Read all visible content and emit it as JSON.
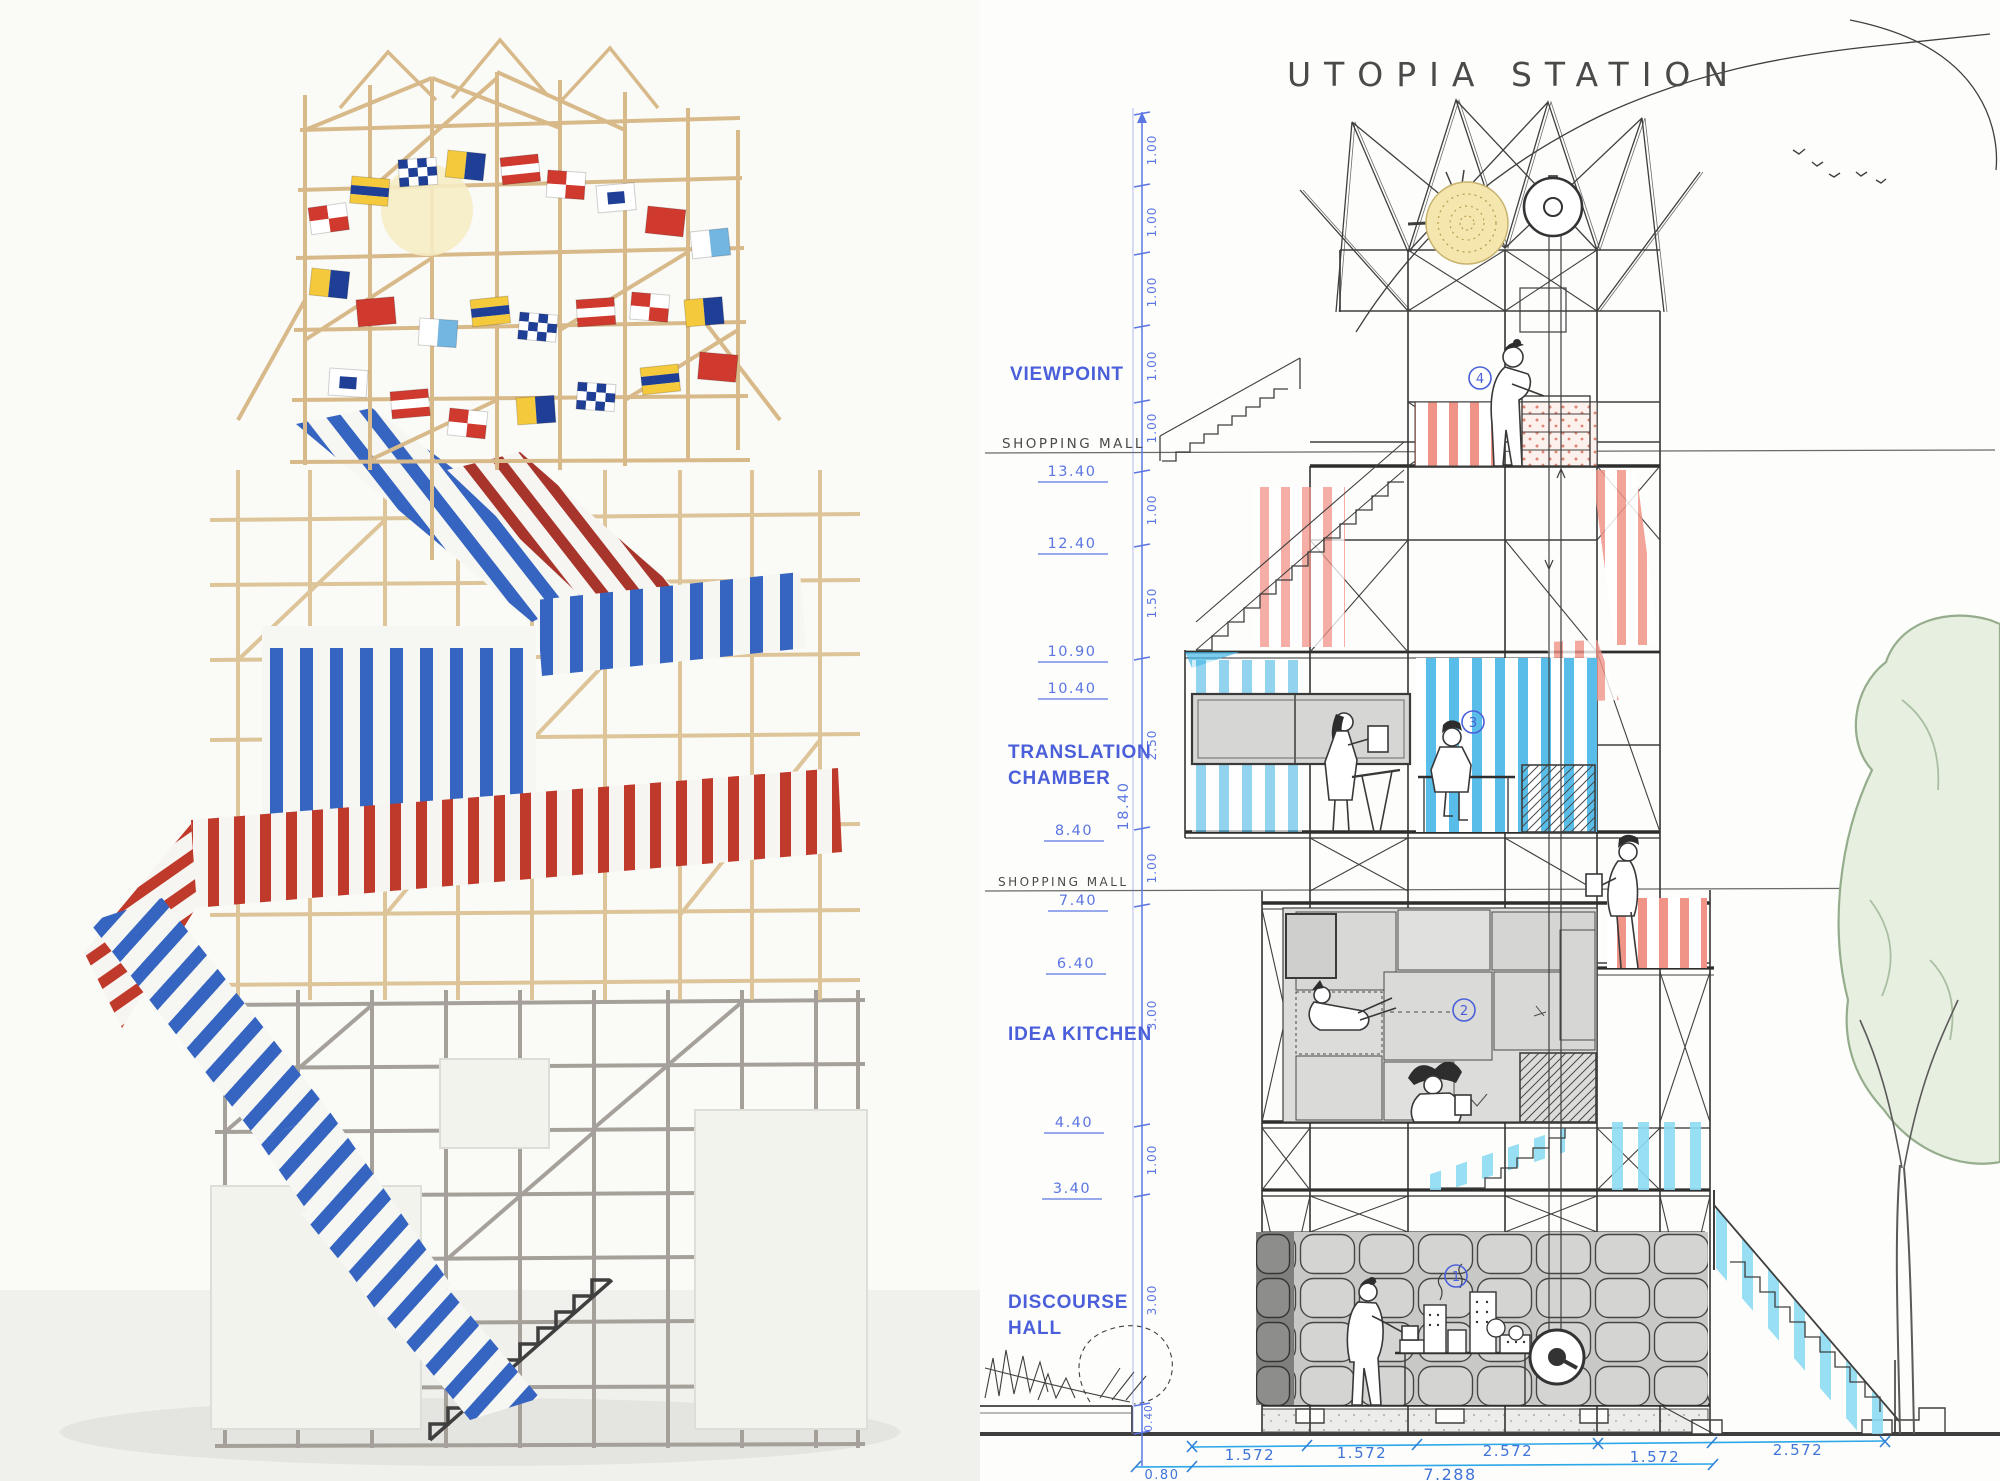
{
  "title": {
    "text": "UTOPIA STATION"
  },
  "rooms": [
    {
      "line1": "VIEWPOINT",
      "line2": ""
    },
    {
      "line1": "TRANSLATION",
      "line2": "CHAMBER"
    },
    {
      "line1": "IDEA KITCHEN",
      "line2": ""
    },
    {
      "line1": "DISCOURSE",
      "line2": "HALL"
    }
  ],
  "pencil_labels": {
    "shopping_mall_upper": "SHOPPING MALL",
    "shopping_mall_lower": "SHOPPING MALL"
  },
  "levels": [
    "13.40",
    "12.40",
    "10.90",
    "10.40",
    "8.40",
    "7.40",
    "6.40",
    "4.40",
    "3.40"
  ],
  "vertical_dims": {
    "segments": [
      "1.00",
      "1.00",
      "1.00",
      "1.00",
      "1.00",
      "1.00",
      "1.50",
      "2.50",
      "1.00",
      "3.00",
      "1.00",
      "3.00",
      "0.40"
    ],
    "total": "18.40"
  },
  "bottom_dims": {
    "row1": [
      "1.572",
      "1.572",
      "2.572",
      "1.572",
      "2.572"
    ],
    "row2_left": "0.80",
    "row2_total": "7.288"
  },
  "markers": [
    "1",
    "2",
    "3",
    "4"
  ],
  "colors": {
    "label_blue": "#4a5fd9",
    "hand_blue": "#5b76e3",
    "dim_cyan": "#2ca7e8",
    "pencil_grey": "#4a4a4a",
    "stripe_red": "#f0897b",
    "stripe_cyan": "#41b4e6",
    "photo_blue": "#3565c0",
    "photo_red": "#bf3a2b",
    "wood_tan": "#d8ba8a",
    "tree_green": "#95ad8c"
  },
  "flags": [
    {
      "t": "rw",
      "x": 308,
      "y": 208,
      "r": -8
    },
    {
      "t": "ys",
      "x": 352,
      "y": 176,
      "r": 5
    },
    {
      "t": "ck",
      "x": 398,
      "y": 160,
      "r": -4
    },
    {
      "t": "by",
      "x": 448,
      "y": 150,
      "r": 6
    },
    {
      "t": "rh",
      "x": 500,
      "y": 158,
      "r": -6
    },
    {
      "t": "rw",
      "x": 548,
      "y": 170,
      "r": 4
    },
    {
      "t": "nw",
      "x": 596,
      "y": 186,
      "r": -5
    },
    {
      "t": "rd",
      "x": 648,
      "y": 206,
      "r": 6
    },
    {
      "t": "bw",
      "x": 690,
      "y": 232,
      "r": -6
    },
    {
      "t": "by",
      "x": 312,
      "y": 268,
      "r": 6
    },
    {
      "t": "rd",
      "x": 356,
      "y": 300,
      "r": -5
    },
    {
      "t": "bw",
      "x": 420,
      "y": 318,
      "r": 4
    },
    {
      "t": "ys",
      "x": 470,
      "y": 300,
      "r": -6
    },
    {
      "t": "ck",
      "x": 520,
      "y": 312,
      "r": 5
    },
    {
      "t": "rh",
      "x": 576,
      "y": 300,
      "r": -4
    },
    {
      "t": "rw",
      "x": 632,
      "y": 292,
      "r": 5
    },
    {
      "t": "by",
      "x": 684,
      "y": 300,
      "r": -5
    },
    {
      "t": "nw",
      "x": 330,
      "y": 368,
      "r": 4
    },
    {
      "t": "rh",
      "x": 390,
      "y": 392,
      "r": -5
    },
    {
      "t": "rw",
      "x": 450,
      "y": 408,
      "r": 6
    },
    {
      "t": "by",
      "x": 516,
      "y": 398,
      "r": -4
    },
    {
      "t": "ck",
      "x": 578,
      "y": 382,
      "r": 4
    },
    {
      "t": "ys",
      "x": 640,
      "y": 368,
      "r": -6
    },
    {
      "t": "rd",
      "x": 700,
      "y": 352,
      "r": 5
    }
  ]
}
